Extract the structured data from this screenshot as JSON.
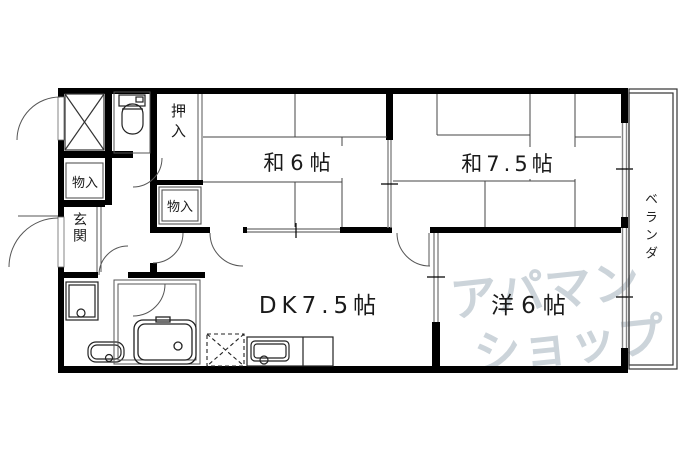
{
  "plan": {
    "rooms": {
      "wa6": {
        "label": "和6帖"
      },
      "wa75": {
        "label": "和7.5帖"
      },
      "dk": {
        "label": "DK7.5帖"
      },
      "yo6": {
        "label": "洋6帖"
      }
    },
    "storage": {
      "oshiire": {
        "label": "押入"
      },
      "monoire_upper": {
        "label": "物入"
      },
      "monoire_lower": {
        "label": "物入"
      }
    },
    "entrance": {
      "label": "玄関"
    },
    "balcony": {
      "label": "ベランダ"
    },
    "watermark": {
      "line1": "アパマン",
      "line2": "ショップ",
      "color": "#ccd4da"
    },
    "colors": {
      "wall": "#000000",
      "thin_line": "#444444",
      "sliding_gray": "#858585"
    }
  }
}
